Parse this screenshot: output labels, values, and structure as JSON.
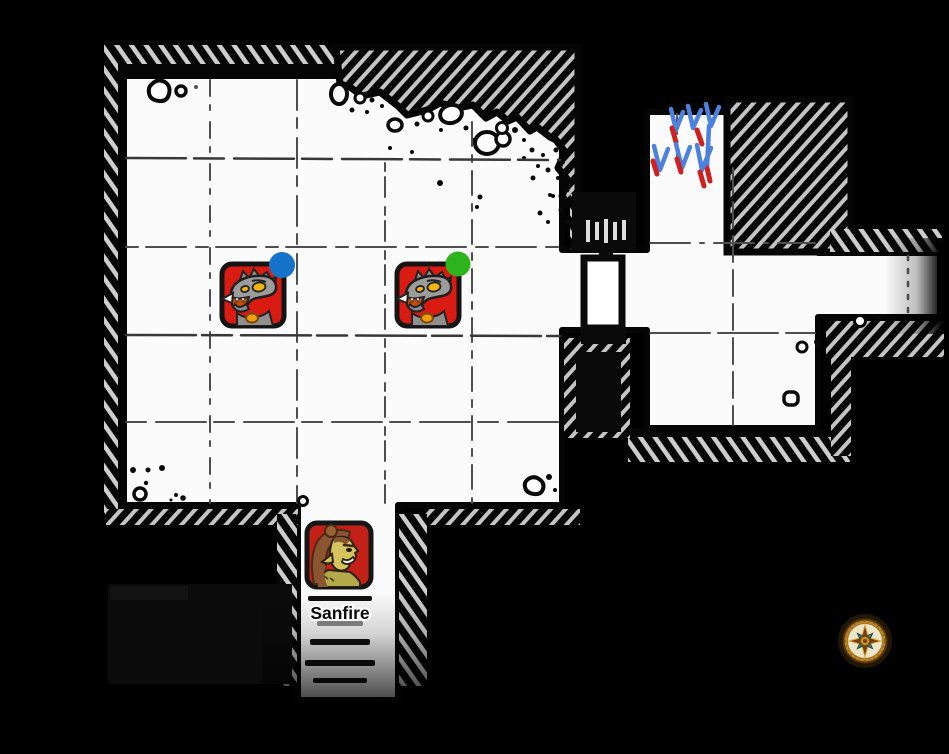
{
  "scene": {
    "background_color": "#000000",
    "floor_color": "#fbfbfb",
    "annotation_arrows": {
      "count": 6,
      "blue": "#4c82dd",
      "red": "#cf1f1f"
    },
    "monster_tokens": [
      {
        "name": "gnoll",
        "bg_color": "#d91b12",
        "status_dot_color": "#1573c9"
      },
      {
        "name": "gnoll",
        "bg_color": "#d91b12",
        "status_dot_color": "#2db31c"
      }
    ],
    "player_token": {
      "label": "Sanfire",
      "bg_color": "#c32017"
    },
    "compass": {
      "ring": "#bf8524",
      "face": "#efe6ca",
      "star_main": "#7d3b16",
      "star_diag": "#2d7f6d",
      "center": "#c9921f"
    }
  }
}
